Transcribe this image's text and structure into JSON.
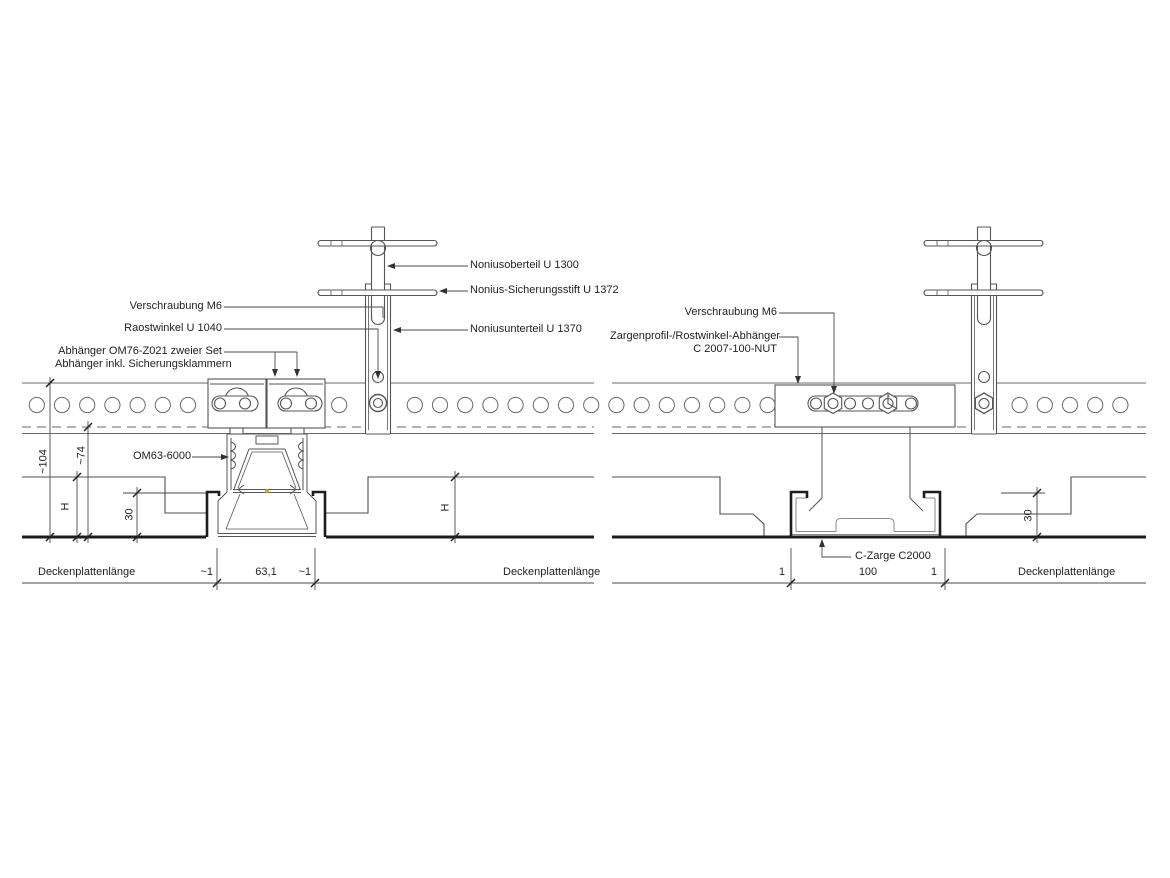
{
  "left": {
    "labels": {
      "verschraubung": "Verschraubung M6",
      "rastwinkel": "Raostwinkel U 1040",
      "abhaenger_line1": "Abhänger OM76-Z021 zweier Set",
      "abhaenger_line2": "Abhänger inkl. Sicherungsklammern",
      "profil": "OM63-6000",
      "noniusoberteil": "Noniusoberteil U 1300",
      "sicherungsstift": "Nonius-Sicherungsstift U 1372",
      "noniusunterteil": "Noniusunterteil U 1370"
    },
    "dims": {
      "height_total": "~104",
      "height_rail": "~74",
      "panel_height_left": "H",
      "edge_height": "30",
      "panel_height_right": "H",
      "gap_left": "~1",
      "profile_width": "63,1",
      "gap_right": "~1",
      "panel_left": "Deckenplattenlänge",
      "panel_right": "Deckenplattenlänge"
    }
  },
  "right": {
    "labels": {
      "verschraubung": "Verschraubung M6",
      "zargenprofil_line1": "Zargenprofil-/Rostwinkel-Abhänger",
      "zargenprofil_line2": "C 2007-100-NUT",
      "czarge": "C-Zarge C2000"
    },
    "dims": {
      "gap_left": "1",
      "opening_width": "100",
      "gap_right": "1",
      "edge_height": "30",
      "panel_right": "Deckenplattenlänge"
    }
  },
  "colors": {
    "line": "#5a5a5a",
    "thick": "#1c1c1c",
    "led_dot": "#d2a62c"
  }
}
